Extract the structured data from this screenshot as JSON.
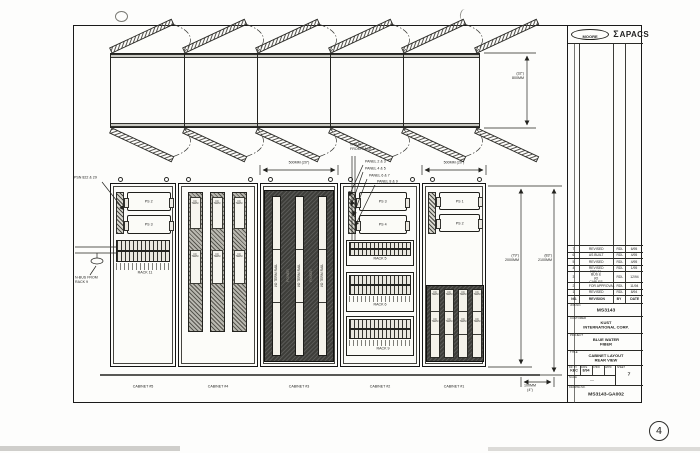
{
  "logo": {
    "moore": "MOORE",
    "apacs_icon": "Σ",
    "apacs": "APACS"
  },
  "page_mark": "4",
  "plan": {
    "dim_depth_in": "(32\")",
    "dim_depth_mm": "800MM"
  },
  "elevation": {
    "dim_cab3_width": "500MM (20\")",
    "dim_cab1_width": "500MM (20\")",
    "dim_inner_in": "(79\")",
    "dim_inner_mm": "2000MM",
    "dim_outer_in": "(83\")",
    "dim_outer_mm": "2100MM",
    "dim_base_mm": "100MM",
    "dim_base_in": "(4\")",
    "cabinet_labels": [
      "CABINET #5",
      "CABINET #4",
      "CABINET #3",
      "CABINET #2",
      "CABINET #1"
    ],
    "callouts": {
      "psn": "PSN 822 & 29",
      "nbus9_l1": "N-BUS FROM",
      "nbus9_l2": "RACK 9",
      "nbus1_l1": "N-BUS",
      "nbus1_l2": "FROM RACK 1",
      "panels": [
        "PANEL 2 & 3",
        "PANEL 4 & 5",
        "PANEL 6 & 7",
        "PANEL 8 & 9"
      ]
    },
    "cab5": {
      "ps1": "PS 2",
      "ps2": "PS 3",
      "rack": "RACK 11"
    },
    "cab2": {
      "ps1": "PS 3",
      "ps2": "PS 4",
      "racks": [
        "RACK 5",
        "RACK 6",
        "RACK 9"
      ]
    },
    "cab1": {
      "ps1": "PS 1",
      "ps2": "PS 2"
    },
    "card_text": "I/O TERM",
    "rail_text": "I/O TERM RAIL",
    "dark_text": "POWER"
  },
  "title_block": {
    "revisions": [
      {
        "no": "7",
        "desc": "REVISED",
        "by": "RDL",
        "date": "6/95"
      },
      {
        "no": "6",
        "desc": "AS BUILT",
        "by": "RDL",
        "date": "4/95"
      },
      {
        "no": "5",
        "desc": "REVISED",
        "by": "RDL",
        "date": "4/95"
      },
      {
        "no": "4",
        "desc": "REVISED",
        "by": "RDL",
        "date": "1/95"
      },
      {
        "no": "3",
        "desc": "RCV N-BUS & I/O CABLES",
        "by": "RDL",
        "date": "12/94"
      },
      {
        "no": "2",
        "desc": "FOR APPROVAL",
        "by": "RDL",
        "date": "11/94"
      },
      {
        "no": "1",
        "desc": "REVISED",
        "by": "RDL",
        "date": "8/94"
      },
      {
        "no": "NO.",
        "desc": "REVISION",
        "by": "BY",
        "date": "DATE"
      }
    ],
    "labels": {
      "job": "JOB NO.",
      "customer": "CUSTOMER",
      "project": "PROJECT",
      "title": "TITLE",
      "drawn": "DR. BY",
      "date": "DATE",
      "chkd": "CHKD",
      "appd": "APPD",
      "scale": "SCALE",
      "sheet": "SHEET",
      "dwg": "DRAWING NO."
    },
    "job_no": "MS3143",
    "customer_l1": "KUST",
    "customer_l2": "INTERNATIONAL CORP.",
    "project_l1": "BLUE WATER",
    "project_l2": "FIBER",
    "title_l1": "CABINET LAYOUT",
    "title_l2": "REAR VIEW",
    "drawn_by": "KEC",
    "drawn_date": "8/94",
    "scale_value": "—",
    "sheet_value": "7",
    "dwg_no": "MS3143-GA002"
  }
}
